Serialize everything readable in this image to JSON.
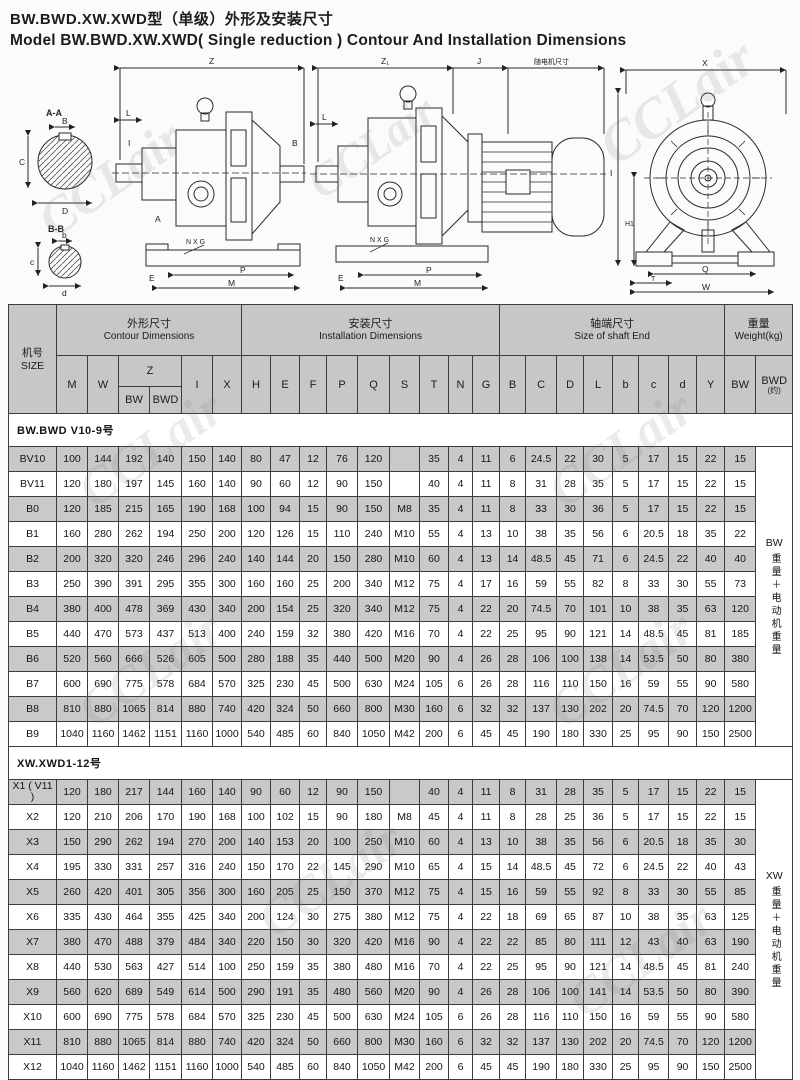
{
  "title": {
    "zh": "BW.BWD.XW.XWD型（单级）外形及安装尺寸",
    "en": "Model BW.BWD.XW.XWD( Single reduction ) Contour And Installation Dimensions"
  },
  "watermark": "CCLair",
  "drawings": {
    "section_view": {
      "a_label": "A-A",
      "b_label": "B-B",
      "a_dims": [
        "B",
        "C",
        "D"
      ],
      "b_dims": [
        "b",
        "c",
        "d"
      ]
    },
    "side_view": {
      "dims": [
        "Z",
        "L",
        "A",
        "I",
        "B",
        "N X G",
        "E",
        "P",
        "M"
      ]
    },
    "motor_view": {
      "dims": [
        "Z₁",
        "J",
        "随电机尺寸",
        "L",
        "N X G",
        "E",
        "P",
        "M"
      ]
    },
    "front_view": {
      "dims": [
        "X",
        "I",
        "H1",
        "Q",
        "T",
        "W"
      ]
    }
  },
  "table": {
    "size_header": {
      "zh": "机号",
      "en": "SIZE"
    },
    "groups": [
      {
        "zh": "外形尺寸",
        "en": "Contour   Dimensions",
        "span": 6
      },
      {
        "zh": "安装尺寸",
        "en": "Installation   Dimensions",
        "span": 9
      },
      {
        "zh": "轴端尺寸",
        "en": "Size of shaft End",
        "span": 8
      },
      {
        "zh": "重量",
        "en": "Weight(kg)",
        "span": 2
      }
    ],
    "letters": [
      {
        "l": "M"
      },
      {
        "l": "W"
      },
      {
        "l": "Z",
        "cs": 2
      },
      {
        "l": "I"
      },
      {
        "l": "X"
      },
      {
        "l": "H"
      },
      {
        "l": "E"
      },
      {
        "l": "F"
      },
      {
        "l": "P"
      },
      {
        "l": "Q"
      },
      {
        "l": "S"
      },
      {
        "l": "T"
      },
      {
        "l": "N"
      },
      {
        "l": "G"
      },
      {
        "l": "B"
      },
      {
        "l": "C"
      },
      {
        "l": "D"
      },
      {
        "l": "L"
      },
      {
        "l": "b"
      },
      {
        "l": "c"
      },
      {
        "l": "d"
      },
      {
        "l": "Y"
      },
      {
        "l": "BW"
      },
      {
        "l": "BWD",
        "sub": "(约)"
      }
    ],
    "z_sub": [
      "BW",
      "BWD"
    ],
    "sections": [
      {
        "title": "BW.BWD V10-9号",
        "note": {
          "head": "BW",
          "body": "重量＋电动机重量"
        },
        "rows": [
          {
            "size": "BV10",
            "values": [
              100,
              144,
              192,
              140,
              150,
              140,
              80,
              47,
              12,
              76,
              120,
              "",
              35,
              4,
              11,
              6,
              24.5,
              22,
              30,
              5,
              17,
              15,
              22,
              15
            ]
          },
          {
            "size": "BV11",
            "values": [
              120,
              180,
              197,
              145,
              160,
              140,
              90,
              60,
              12,
              90,
              150,
              "",
              40,
              4,
              11,
              8,
              31,
              28,
              35,
              5,
              17,
              15,
              22,
              15
            ]
          },
          {
            "size": "B0",
            "values": [
              120,
              185,
              215,
              165,
              190,
              168,
              100,
              94,
              15,
              90,
              150,
              "M8",
              35,
              4,
              11,
              8,
              33,
              30,
              36,
              5,
              17,
              15,
              22,
              15
            ]
          },
          {
            "size": "B1",
            "values": [
              160,
              280,
              262,
              194,
              250,
              200,
              120,
              126,
              15,
              110,
              240,
              "M10",
              55,
              4,
              13,
              10,
              38,
              35,
              56,
              6,
              20.5,
              18,
              35,
              22
            ]
          },
          {
            "size": "B2",
            "values": [
              200,
              320,
              320,
              246,
              296,
              240,
              140,
              144,
              20,
              150,
              280,
              "M10",
              60,
              4,
              13,
              14,
              48.5,
              45,
              71,
              6,
              24.5,
              22,
              40,
              40
            ]
          },
          {
            "size": "B3",
            "values": [
              250,
              390,
              391,
              295,
              355,
              300,
              160,
              160,
              25,
              200,
              340,
              "M12",
              75,
              4,
              17,
              16,
              59,
              55,
              82,
              8,
              33,
              30,
              55,
              73
            ]
          },
          {
            "size": "B4",
            "values": [
              380,
              400,
              478,
              369,
              430,
              340,
              200,
              154,
              25,
              320,
              340,
              "M12",
              75,
              4,
              22,
              20,
              74.5,
              70,
              101,
              10,
              38,
              35,
              63,
              120
            ]
          },
          {
            "size": "B5",
            "values": [
              440,
              470,
              573,
              437,
              513,
              400,
              240,
              159,
              32,
              380,
              420,
              "M16",
              70,
              4,
              22,
              25,
              95,
              90,
              121,
              14,
              48.5,
              45,
              81,
              185
            ]
          },
          {
            "size": "B6",
            "values": [
              520,
              560,
              666,
              526,
              605,
              500,
              280,
              188,
              35,
              440,
              500,
              "M20",
              90,
              4,
              26,
              28,
              106,
              100,
              138,
              14,
              53.5,
              50,
              80,
              380
            ]
          },
          {
            "size": "B7",
            "values": [
              600,
              690,
              775,
              578,
              684,
              570,
              325,
              230,
              45,
              500,
              630,
              "M24",
              105,
              6,
              26,
              28,
              116,
              110,
              150,
              16,
              59,
              55,
              90,
              580
            ]
          },
          {
            "size": "B8",
            "values": [
              810,
              880,
              1065,
              814,
              880,
              740,
              420,
              324,
              50,
              660,
              800,
              "M30",
              160,
              6,
              32,
              32,
              137,
              130,
              202,
              20,
              74.5,
              70,
              120,
              1200
            ]
          },
          {
            "size": "B9",
            "values": [
              1040,
              1160,
              1462,
              1151,
              1160,
              1000,
              540,
              485,
              60,
              840,
              1050,
              "M42",
              200,
              6,
              45,
              45,
              190,
              180,
              330,
              25,
              95,
              90,
              150,
              2500
            ]
          }
        ]
      },
      {
        "title": "XW.XWD1-12号",
        "note": {
          "head": "XW",
          "body": "重量＋电动机重量"
        },
        "rows": [
          {
            "size": "X1 ( V11 )",
            "values": [
              120,
              180,
              217,
              144,
              160,
              140,
              90,
              60,
              12,
              90,
              150,
              "",
              40,
              4,
              11,
              8,
              31,
              28,
              35,
              5,
              17,
              15,
              22,
              15
            ]
          },
          {
            "size": "X2",
            "values": [
              120,
              210,
              206,
              170,
              190,
              168,
              100,
              102,
              15,
              90,
              180,
              "M8",
              45,
              4,
              11,
              8,
              28,
              25,
              36,
              5,
              17,
              15,
              22,
              15
            ]
          },
          {
            "size": "X3",
            "values": [
              150,
              290,
              262,
              194,
              270,
              200,
              140,
              153,
              20,
              100,
              250,
              "M10",
              60,
              4,
              13,
              10,
              38,
              35,
              56,
              6,
              20.5,
              18,
              35,
              30
            ]
          },
          {
            "size": "X4",
            "values": [
              195,
              330,
              331,
              257,
              316,
              240,
              150,
              170,
              22,
              145,
              290,
              "M10",
              65,
              4,
              15,
              14,
              48.5,
              45,
              72,
              6,
              24.5,
              22,
              40,
              43
            ]
          },
          {
            "size": "X5",
            "values": [
              260,
              420,
              401,
              305,
              356,
              300,
              160,
              205,
              25,
              150,
              370,
              "M12",
              75,
              4,
              15,
              16,
              59,
              55,
              92,
              8,
              33,
              30,
              55,
              85
            ]
          },
          {
            "size": "X6",
            "values": [
              335,
              430,
              464,
              355,
              425,
              340,
              200,
              124,
              30,
              275,
              380,
              "M12",
              75,
              4,
              22,
              18,
              69,
              65,
              87,
              10,
              38,
              35,
              63,
              125
            ]
          },
          {
            "size": "X7",
            "values": [
              380,
              470,
              488,
              379,
              484,
              340,
              220,
              150,
              30,
              320,
              420,
              "M16",
              90,
              4,
              22,
              22,
              85,
              80,
              111,
              12,
              43,
              40,
              63,
              190
            ]
          },
          {
            "size": "X8",
            "values": [
              440,
              530,
              563,
              427,
              514,
              100,
              250,
              159,
              35,
              380,
              480,
              "M16",
              70,
              4,
              22,
              25,
              95,
              90,
              121,
              14,
              48.5,
              45,
              81,
              240
            ]
          },
          {
            "size": "X9",
            "values": [
              560,
              620,
              689,
              549,
              614,
              500,
              290,
              191,
              35,
              480,
              560,
              "M20",
              90,
              4,
              26,
              28,
              106,
              100,
              141,
              14,
              53.5,
              50,
              80,
              390
            ]
          },
          {
            "size": "X10",
            "values": [
              600,
              690,
              775,
              578,
              684,
              570,
              325,
              230,
              45,
              500,
              630,
              "M24",
              105,
              6,
              26,
              28,
              116,
              110,
              150,
              16,
              59,
              55,
              90,
              580
            ]
          },
          {
            "size": "X11",
            "values": [
              810,
              880,
              1065,
              814,
              880,
              740,
              420,
              324,
              50,
              660,
              800,
              "M30",
              160,
              6,
              32,
              32,
              137,
              130,
              202,
              20,
              74.5,
              70,
              120,
              1200
            ]
          },
          {
            "size": "X12",
            "values": [
              1040,
              1160,
              1462,
              1151,
              1160,
              1000,
              540,
              485,
              60,
              840,
              1050,
              "M42",
              200,
              6,
              45,
              45,
              190,
              180,
              330,
              25,
              95,
              90,
              150,
              2500
            ]
          }
        ]
      }
    ]
  }
}
